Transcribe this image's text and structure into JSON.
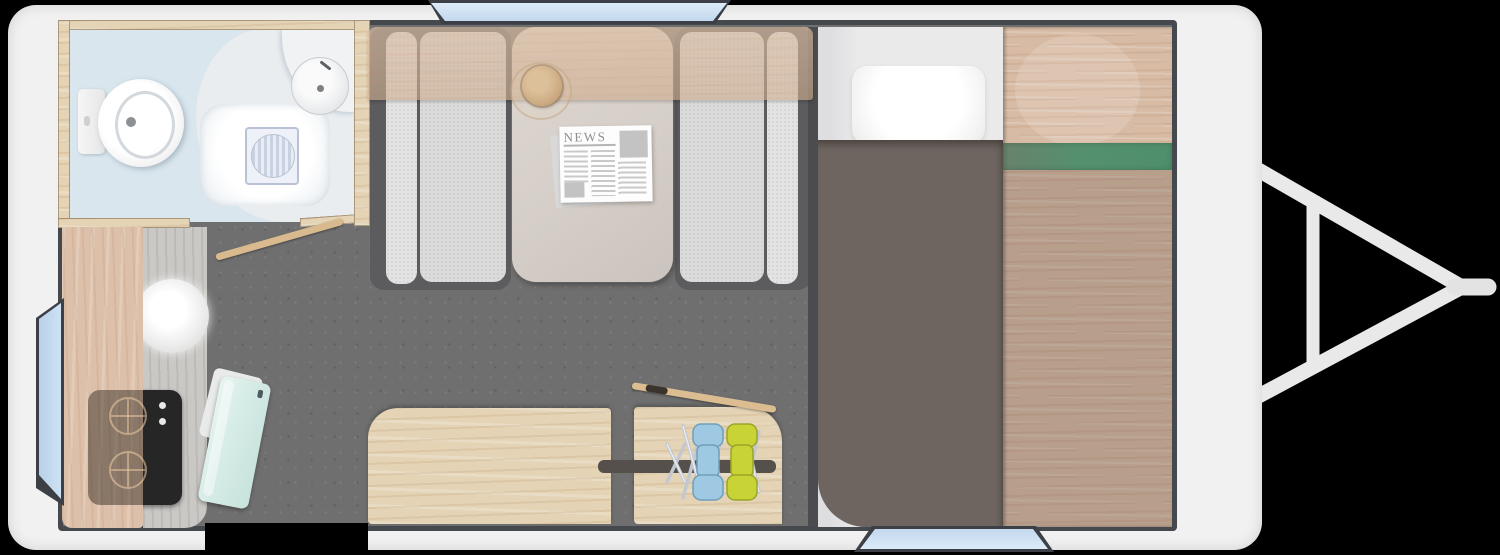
{
  "scene": {
    "type": "caravan-floor-plan-top-view",
    "orientation": "hitch-on-right",
    "window_count": 3,
    "doorway_count": 1
  },
  "newspaper": {
    "masthead": "NEWS"
  },
  "colors": {
    "background": "#000000",
    "body_shell": "#f1f1f1",
    "wall_line": "#45484c",
    "floor_gray": "#6f6f6f",
    "bathroom_floor_blue": "#d9e6ee",
    "bathroom_floor_light": "#e9edf0",
    "wood_frame": "#d2b384",
    "wood_pine": "#e4d3b5",
    "wood_pink": "#dcc0a9",
    "counter_gray": "#c9c8c5",
    "hob_black": "#262626",
    "entry_door_mint": "#d6ece7",
    "seat_frame_gray": "#5c5c5f",
    "cushion_gray": "#dbdbdb",
    "table_top": "#d6cfc9",
    "duvet_taupe": "#6e6560",
    "pillow_white": "#fbfbfb",
    "bed_board_green": "#54906e",
    "window_blue": "#cfe2f4",
    "window_frame": "#3c4046",
    "hitch_gray": "#e9e9e9",
    "folding_chair_blue": "#9fc9e2",
    "folding_chair_yellow": "#c8d335",
    "chrome": "#c3c8d0",
    "slot_rail_dark": "#55504b"
  },
  "rooms": {
    "bathroom": {
      "fixtures": [
        "toilet",
        "shower-tray",
        "floor-drain",
        "corner-washbasin",
        "door-open"
      ]
    },
    "kitchen": {
      "fixtures": [
        "round-sink",
        "two-burner-hob",
        "worktop-flap",
        "hob-knobs"
      ]
    },
    "dinette": {
      "fixtures": [
        "bench-seat-left",
        "table",
        "bench-seat-right",
        "newspaper",
        "coffee-cup",
        "overhead-locker"
      ]
    },
    "bedroom": {
      "fixtures": [
        "mattress",
        "pillow",
        "duvet",
        "bed-board",
        "green-stripe"
      ]
    },
    "storage": {
      "contents": [
        "folding-chair-blue",
        "folding-chair-yellow",
        "lid-plank",
        "slot-rail"
      ]
    }
  }
}
